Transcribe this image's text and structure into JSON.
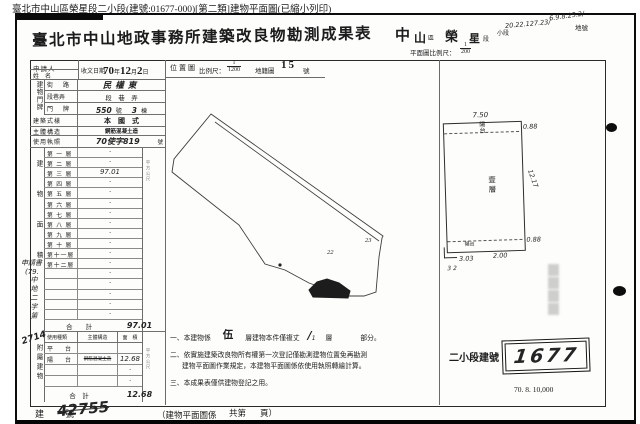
{
  "window_title": "臺北市中山區榮星段二小段(建號:01677-000)[第二類]建物平面圖(已縮小列印)",
  "header": {
    "title": "臺北市中山地政事務所建築改良物勘測成果表",
    "district_big": "中",
    "district_big2": "山",
    "district_suffix": "區",
    "section_big": "榮",
    "section_big2": "星",
    "section_suffix": "段",
    "subsection_label": "小段",
    "lot_label": "地號",
    "hw_note_top": "6.9.8.25.2/",
    "hw_lots": "20.22.127.23/",
    "plan_scale_label": "平面圖比例尺：",
    "plan_scale_num": "1",
    "plan_scale_den": "200"
  },
  "apply_row": {
    "applicant": "申請人",
    "name": "姓　名",
    "received": "收文日期",
    "date_y": "70",
    "date_y_label": "年",
    "date_m": "12",
    "date_m_label": "月",
    "date_d": "2",
    "date_d_label": "日",
    "loc_label": "位置圖",
    "loc_scale_label": "比例尺：",
    "loc_num": "1",
    "loc_den": "1200",
    "cad_label": "地籍圖",
    "cad_no": "15",
    "cad_suffix": "號"
  },
  "building": {
    "group_door": "建物門牌",
    "group_area": "建物面積",
    "group_attached": "附屬建物",
    "street_label": "街　路",
    "street_value": "民權東",
    "lane_label": "段巷弄",
    "lane_value": "段　巷　弄",
    "door_label": "門　牌",
    "door_hw1": "550",
    "door_p1": "號",
    "door_hw2": "3",
    "door_p2": "棟",
    "style_label": "建築式樣",
    "style_value": "本　國　式",
    "struct_label": "主體構造",
    "struct_value": "鋼筋混凝土造",
    "license_label": "使用執照",
    "license_hw": "70使字819",
    "license_suffix": "號",
    "tiny_unit": "平方公尺",
    "total_floors_label": "合　　計",
    "total_floors_value": "97.01",
    "attached_use_label": "使用種類",
    "attached_struct_label": "主體構造",
    "attached_area_label": "面　積",
    "total_attached_label": "合　計",
    "total_attached_value": "12.68"
  },
  "floors": [
    {
      "label": "第 一 層",
      "value": "·"
    },
    {
      "label": "第 二 層",
      "value": "·"
    },
    {
      "label": "第 三 層",
      "value": "97.01"
    },
    {
      "label": "第 四 層",
      "value": "·"
    },
    {
      "label": "第 五 層",
      "value": "·"
    },
    {
      "label": "第 六 層",
      "value": "·"
    },
    {
      "label": "第 七 層",
      "value": "·"
    },
    {
      "label": "第 八 層",
      "value": "·"
    },
    {
      "label": "第 九 層",
      "value": "·"
    },
    {
      "label": "第 十 層",
      "value": "·"
    },
    {
      "label": "第十一層",
      "value": "·"
    },
    {
      "label": "第十二層",
      "value": "·"
    },
    {
      "label": "",
      "value": "·"
    },
    {
      "label": "",
      "value": "·"
    },
    {
      "label": "",
      "value": "·"
    },
    {
      "label": "",
      "value": "·"
    },
    {
      "label": "",
      "value": "·"
    }
  ],
  "attached_rows": [
    {
      "use": "平　台",
      "structure": "",
      "area": ""
    },
    {
      "use": "陽　台",
      "structure": "鋼筋混凝土造",
      "area": "12.68"
    },
    {
      "use": "",
      "structure": "",
      "area": "·"
    },
    {
      "use": "",
      "structure": "",
      "area": "·"
    }
  ],
  "margin_note": {
    "line1": "申請書",
    "line2": "(79.",
    "vchars": "中地二字第",
    "number": "2714"
  },
  "sketch": {
    "mark_a": "22",
    "mark_b": "23"
  },
  "plan": {
    "balcony_top": "陽台",
    "unit_label": "壹層",
    "balcony_bottom": "陽台",
    "dim_top": "7.50",
    "dim_right_top": "0.88",
    "dim_right_mid": "12.17",
    "dim_right_bottom": "0.88",
    "dim_bottom_a": "3.03",
    "dim_bottom_b": "2.00",
    "hw_marks": "3  2"
  },
  "notes": {
    "n1_pre": "一、本建物係",
    "n1_floors": "伍",
    "n1_mid": "層建物本件僅複丈",
    "n1_hw": "∕",
    "n1_hw_sub": "1",
    "n1_post1": "層",
    "n1_post2": "部分。",
    "n2_line1": "二、依實施建築改良物所有權第一次登記僅勘測建物位置免再勘測",
    "n2_line2": "建物平面圖作業規定，本建物平面圖係依使用執照轉繪計算。",
    "n3": "三、本成果表僅供建物登記之用。"
  },
  "stamp": {
    "label": "二小段建號",
    "value": "1677"
  },
  "print_code": "70. 8. 10,000",
  "footer": {
    "label": "建　號",
    "hw_value": "42755",
    "paren_left": "（建物平面圖係",
    "paren_mid": "共第",
    "paren_right": "頁）"
  }
}
